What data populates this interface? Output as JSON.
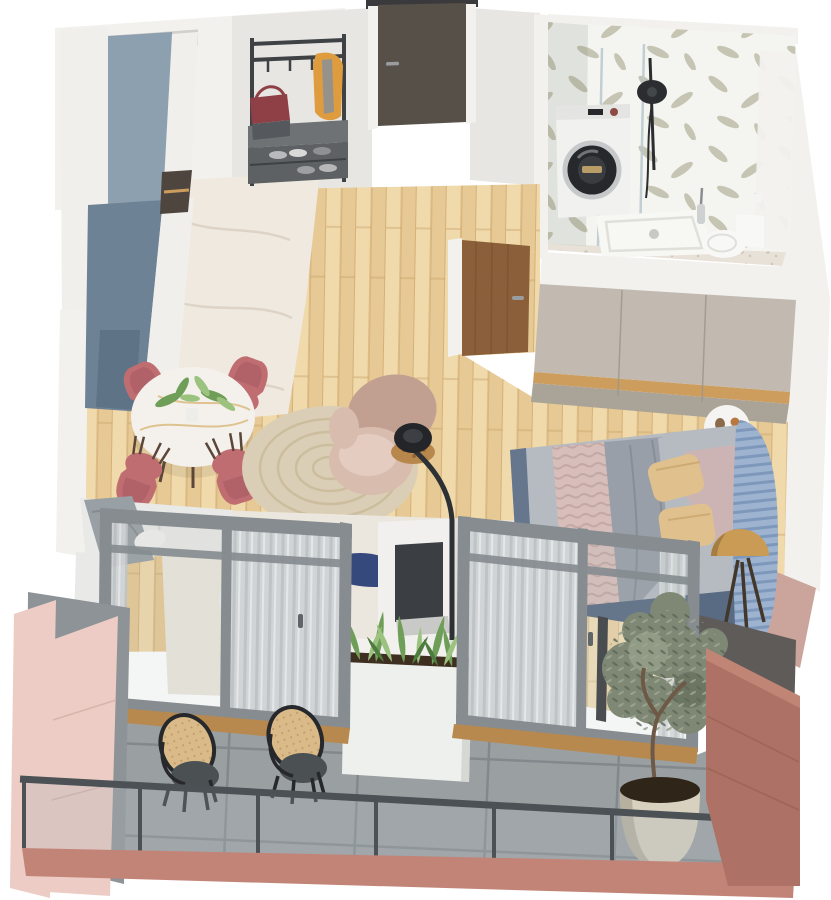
{
  "meta": {
    "description": "Isometric 3D rendered floor plan of a one-bedroom apartment with balcony",
    "render_style": "top-down axonometric interior visualization",
    "visible_text": ""
  },
  "scene": {
    "rooms": [
      {
        "name": "entry-hall",
        "items": [
          "entry-door",
          "coat-rack",
          "hanging-bag",
          "hanging-jacket",
          "shoe-bench",
          "shoes"
        ]
      },
      {
        "name": "kitchen",
        "items": [
          "tall-cabinet-run",
          "blue-gray-counter",
          "white-cabinet-fronts",
          "counter-niche",
          "marble-floor"
        ]
      },
      {
        "name": "bathroom",
        "items": [
          "leaf-wallpaper",
          "washing-machine",
          "walk-in-shower",
          "shower-glass",
          "shower-tray",
          "toilet",
          "toilet-brush",
          "terrazzo-floor"
        ]
      },
      {
        "name": "living-dining",
        "items": [
          "round-marble-dining-table",
          "dining-chairs",
          "table-plant",
          "curved-beige-armchair",
          "jute-round-rug",
          "arc-floor-lamp",
          "rattan-side-table",
          "sectional-sofa",
          "white-armchair",
          "abstract-area-rug",
          "tv-partition",
          "tv"
        ]
      },
      {
        "name": "bedroom",
        "items": [
          "wardrobe",
          "bedroom-door",
          "double-bed",
          "gray-duvet",
          "pink-knit-throw",
          "gold-pillows",
          "blush-pillows",
          "ribbed-headboard",
          "round-bedside-table",
          "brass-dome-lamp",
          "accent-pink-wall"
        ]
      },
      {
        "name": "balcony",
        "items": [
          "tile-floor",
          "white-planter-box",
          "spiky-plants",
          "lounge-chairs",
          "olive-tree-in-pot",
          "glass-railing",
          "pink-exterior-walls",
          "terracotta-wall"
        ]
      }
    ],
    "counts": {
      "dining_chairs": 4,
      "balcony_lounge_chairs": 2,
      "sliding_door_units": 2,
      "rooms": 6
    }
  },
  "palette": {
    "bg": "#ffffff",
    "wallWhite": "#f2f1ee",
    "wallShade": "#e0dfdb",
    "hallWall": "#e7e6e3",
    "niche": "#c9c8c4",
    "woodLight": "#f0d9ab",
    "woodMid": "#e6c994",
    "woodSeam": "#c9a166",
    "marble": "#efe9df",
    "marbleVein": "#d8cec0",
    "kitchenTop": "#8da0af",
    "kitchenFront": "#6e8296",
    "kitchenEnd": "#5d7184",
    "kitchenWhite": "#f0efec",
    "counterDark": "#4e463e",
    "doorDark": "#575048",
    "doorSill": "#3a3a3c",
    "rackDark": "#3e4245",
    "benchTop": "#6e7275",
    "benchFront": "#5d6164",
    "bagRed": "#8e4046",
    "bagGray": "#55585c",
    "jacketOrange": "#df9c3f",
    "wallpaper": "#f4f5f0",
    "leafOlive": "#b2b198",
    "washerWhite": "#f1f1ef",
    "washerDark": "#26282b",
    "washerRing": "#c7c8ca",
    "glassLine": "#b9c8d0",
    "showerBlack": "#2b2d30",
    "trayWhite": "#f7f7f4",
    "trayLine": "#e0e0da",
    "toiletWhite": "#f8f8f6",
    "bathFloor": "#e8e1d7",
    "speck": "#cfc5b5",
    "wardUpper": "#c2bab0",
    "wardLower": "#aaa498",
    "wardWood": "#cd9d5e",
    "wardSeam": "#9b958b",
    "bedDoorWood": "#8a5f3a",
    "doorGrain": "#734f2e",
    "tableWhite": "#f4f1ec",
    "tableVein": "#d8b87a",
    "chairRose": "#c06d72",
    "chairRoseDark": "#a25a60",
    "legBrown": "#5b4639",
    "plantGreen": "#6f9e59",
    "plantLight": "#9cc27f",
    "plantDark": "#4e7c3f",
    "juteRug": "#dbceb6",
    "juteRing": "#c7b795",
    "armBeige": "#d8bdaf",
    "armBeigeLight": "#e4cdc0",
    "armBeigeDark": "#c1a092",
    "lampBlack": "#232529",
    "lampPole": "#2e3134",
    "rattan": "#b8874c",
    "sofaWhite": "#e9e9e7",
    "sofaShade": "#d8d8d6",
    "throwGray": "#99a0a5",
    "rugBase": "#ece7de",
    "rugNavy": "#35497c",
    "rugTan": "#d9b98d",
    "rugBlue": "#b3bfcc",
    "tvDark": "#3b3f43",
    "pillarWhite": "#f1f0ee",
    "duvetGray": "#999fa8",
    "duvetLight": "#b6bbc2",
    "knitPink": "#d7beba",
    "knitLine": "#c2a7a4",
    "pillowGold": "#e0c08d",
    "pillowGoldD": "#c9a66d",
    "pillowBlush": "#cdb4b4",
    "headboardBlue": "#9db3cf",
    "headboardShade": "#7e98bb",
    "bedFrame": "#66778d",
    "bedBase": "#596a83",
    "sideWhite": "#f5f4f2",
    "domeGold": "#c99b55",
    "domeDark": "#9c743c",
    "tripod": "#43372a",
    "accentPink": "#cba49c",
    "frameGray": "#868c90",
    "frameDark": "#5f6569",
    "sillWood": "#b8894f",
    "curtain": "#d6d9db",
    "curtainShade": "#c1c5c8",
    "curtainLight": "#edeff1",
    "tile": "#9aa0a2",
    "tileLine": "#82888b",
    "planterWhite": "#eef0ed",
    "planterShade": "#d6d8d4",
    "soil": "#3e2f21",
    "cane": "#d9ba88",
    "caneDark": "#b08e58",
    "chairBlack": "#26282b",
    "seatDark": "#4b5053",
    "oliveMid": "#7e8874",
    "oliveLight": "#9aa48e",
    "oliveDark": "#5e6856",
    "trunk": "#6d5946",
    "pot": "#d9d1c0",
    "potShade": "#b8b09f",
    "rail": "#4b5154",
    "glassTint": "#aeb6b9",
    "pinkLight": "#ecccc4",
    "terracotta": "#ad7265",
    "terraLight": "#c08575",
    "fascia": "#c38478",
    "grayWall": "#8d9396",
    "darkWall": "#5f5b58"
  }
}
